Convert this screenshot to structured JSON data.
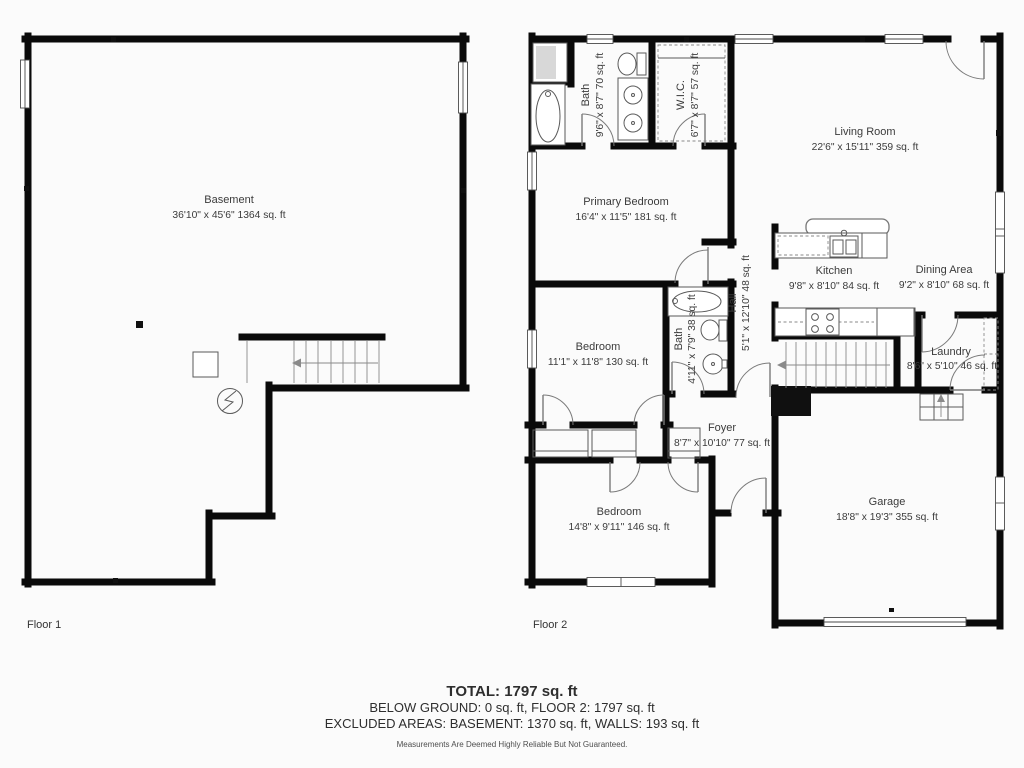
{
  "colors": {
    "background": "#fbfbfb",
    "walls": "#0a0a0a",
    "text": "#3b3b3b",
    "fixtures": "#5a5a5a"
  },
  "floor1": {
    "label": "Floor 1",
    "rooms": {
      "basement": {
        "name": "Basement",
        "dims": "36'10\" x 45'6\" 1364 sq. ft"
      }
    }
  },
  "floor2": {
    "label": "Floor 2",
    "rooms": {
      "bath1": {
        "name": "Bath",
        "dims": "9'6\" x 8'7\" 70 sq. ft"
      },
      "wic": {
        "name": "W.I.C.",
        "dims": "6'7\" x 8'7\" 57 sq. ft"
      },
      "living": {
        "name": "Living Room",
        "dims": "22'6\" x 15'11\" 359 sq. ft"
      },
      "primary": {
        "name": "Primary Bedroom",
        "dims": "16'4\" x 11'5\" 181 sq. ft"
      },
      "kitchen": {
        "name": "Kitchen",
        "dims": "9'8\" x 8'10\" 84 sq. ft"
      },
      "dining": {
        "name": "Dining Area",
        "dims": "9'2\" x 8'10\" 68 sq. ft"
      },
      "hall": {
        "name": "Hall",
        "dims": "5'1\" x 12'10\" 48 sq. ft"
      },
      "bedroom1": {
        "name": "Bedroom",
        "dims": "11'1\" x 11'8\" 130 sq. ft"
      },
      "bath2": {
        "name": "Bath",
        "dims": "4'11\" x 7'9\" 38 sq. ft"
      },
      "laundry": {
        "name": "Laundry",
        "dims": "8'6\" x 5'10\" 46 sq. ft"
      },
      "foyer": {
        "name": "Foyer",
        "dims": "8'7\" x 10'10\" 77 sq. ft"
      },
      "bedroom2": {
        "name": "Bedroom",
        "dims": "14'8\" x 9'11\" 146 sq. ft"
      },
      "garage": {
        "name": "Garage",
        "dims": "18'8\" x 19'3\" 355 sq. ft"
      }
    }
  },
  "summary": {
    "total": "TOTAL: 1797 sq. ft",
    "below_ground_line": "BELOW GROUND: 0 sq. ft, FLOOR 2: 1797 sq. ft",
    "excluded_line": "EXCLUDED AREAS: BASEMENT: 1370 sq. ft, WALLS: 193 sq. ft",
    "disclaimer": "Measurements Are Deemed Highly Reliable But Not Guaranteed."
  }
}
